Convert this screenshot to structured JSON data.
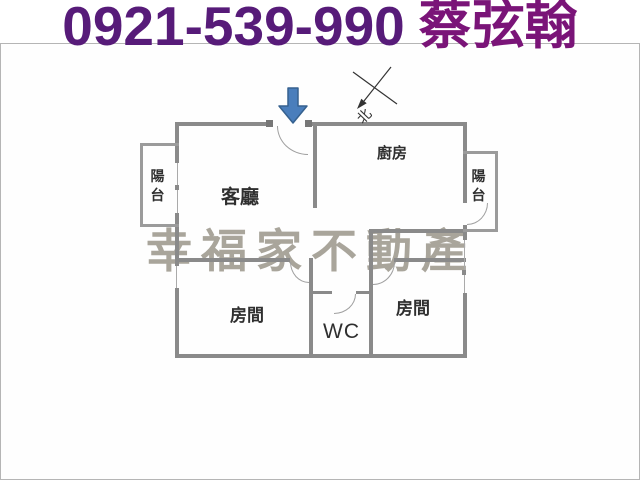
{
  "header": {
    "phone": "0921-539-990",
    "agent_name": "蔡弦翰"
  },
  "floorplan": {
    "watermark": "幸福家不動產",
    "compass_label": "北",
    "rooms": {
      "living_room": "客廳",
      "kitchen": "廚房",
      "bedroom_left": "房間",
      "bedroom_right": "房間",
      "wc": "WC",
      "balcony_left": "陽台",
      "balcony_right": "陽台"
    },
    "colors": {
      "phone_text": "#571b79",
      "agent_text": "#7a1478",
      "wall": "#8a8a8a",
      "watermark": "#a29e93",
      "arrow_fill": "#4a7ebc",
      "arrow_stroke": "#36618f",
      "compass_line": "#333333"
    }
  }
}
